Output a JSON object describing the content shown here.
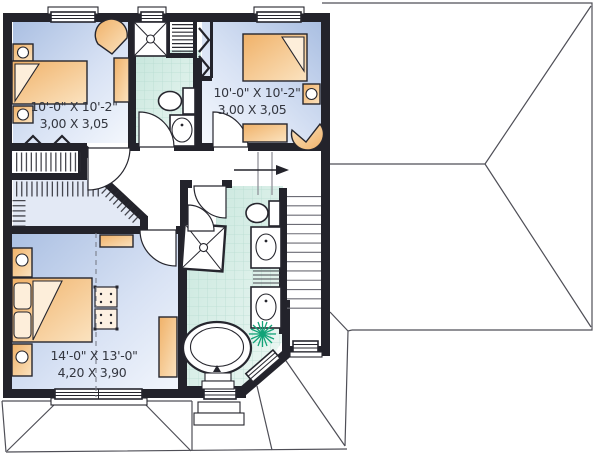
{
  "plan_labels": {
    "bedroom_top_left": {
      "imperial": "10'-0\" X 10'-2\"",
      "metric": "3,00 X 3,05"
    },
    "bedroom_top_right": {
      "imperial": "10'-0\" X 10'-2\"",
      "metric": "3,00 X 3,05"
    },
    "master_bedroom": {
      "imperial": "14'-0\" X 13'-0\"",
      "metric": "4,20 X 3,90"
    }
  },
  "icons": {
    "stair_direction_arrow": "arrow-right",
    "plant": "plant-asterisk",
    "closet_doors": "bifold-chevrons"
  },
  "colors": {
    "wall": "#23232b",
    "bedroom_floor_edge": "#aabfe2",
    "bedroom_floor_center": "#f5f8fd",
    "tile_floor": "#cfe9e0",
    "tile_grid": "#b2d9cd",
    "furniture": "#f2b877",
    "furniture_light": "#fdeeda",
    "roof_line": "#4f4f57",
    "plant_green": "#12a378",
    "dimension_text": "#33363f"
  }
}
